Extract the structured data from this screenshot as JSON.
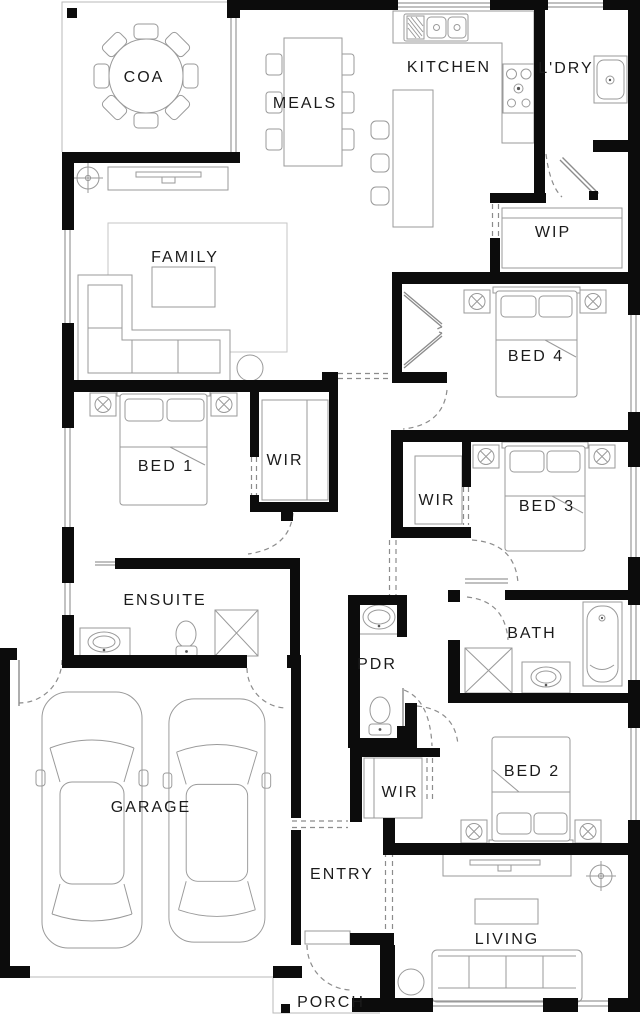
{
  "meta": {
    "type": "architectural-floor-plan",
    "canvas": {
      "width": 640,
      "height": 1023
    }
  },
  "colors": {
    "background": "#ffffff",
    "walls": "#0c0c0c",
    "furniture_outline": "#9a9a9a",
    "door_swing": "#8c8c8c",
    "label_text": "#1b1b1b"
  },
  "rooms": [
    {
      "id": "coa",
      "label": "COA"
    },
    {
      "id": "meals",
      "label": "MEALS"
    },
    {
      "id": "kitchen",
      "label": "KITCHEN"
    },
    {
      "id": "laundry",
      "label": "L'DRY"
    },
    {
      "id": "wip",
      "label": "WIP"
    },
    {
      "id": "family",
      "label": "FAMILY"
    },
    {
      "id": "bed4",
      "label": "BED 4"
    },
    {
      "id": "bed1",
      "label": "BED 1"
    },
    {
      "id": "wir-bed1",
      "label": "WIR"
    },
    {
      "id": "wir-bed3",
      "label": "WIR"
    },
    {
      "id": "bed3",
      "label": "BED 3"
    },
    {
      "id": "ensuite",
      "label": "ENSUITE"
    },
    {
      "id": "pdr",
      "label": "PDR"
    },
    {
      "id": "bath",
      "label": "BATH"
    },
    {
      "id": "bed2",
      "label": "BED 2"
    },
    {
      "id": "wir-bed2",
      "label": "WIR"
    },
    {
      "id": "garage",
      "label": "GARAGE"
    },
    {
      "id": "entry",
      "label": "ENTRY"
    },
    {
      "id": "living",
      "label": "LIVING"
    },
    {
      "id": "porch",
      "label": "PORCH"
    }
  ]
}
